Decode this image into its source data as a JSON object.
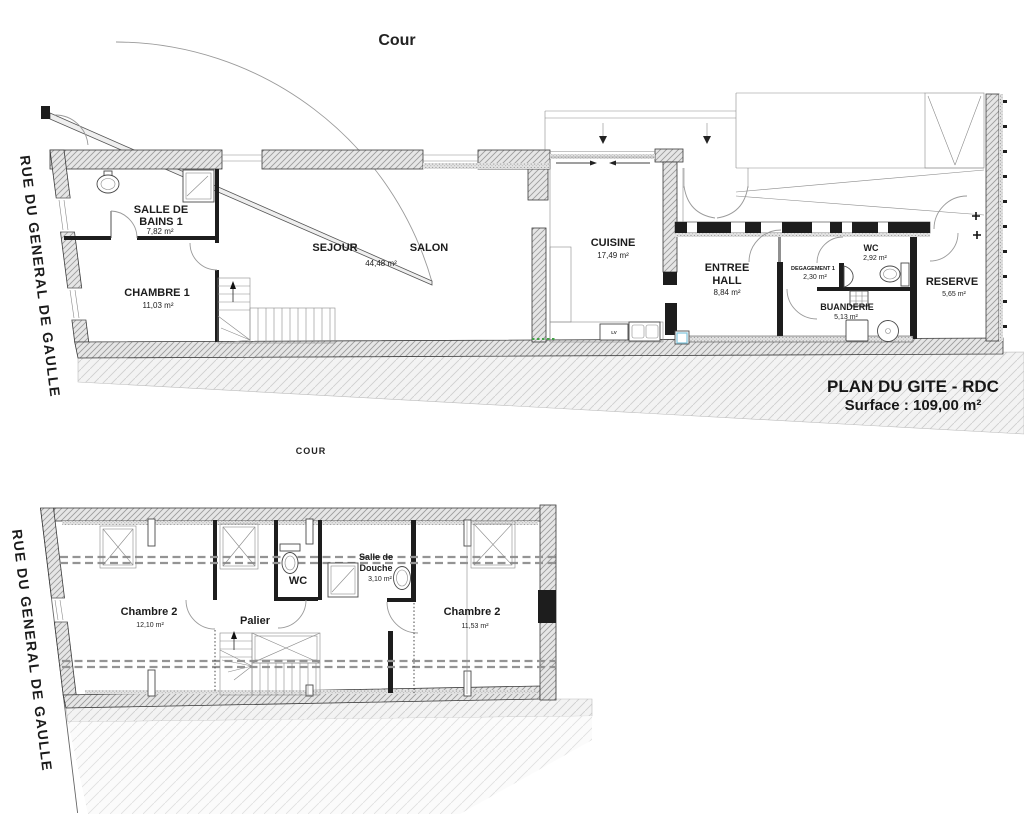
{
  "colors": {
    "line": "#2b2b2b",
    "wall_hatch": "#e6e6e6",
    "green_marker": "#43a047",
    "blue_marker": "#7fc4dc"
  },
  "labels": {
    "cour_top": "Cour",
    "cour_etage": "COUR",
    "street_top": "RUE DU GENERAL DE GAULLE",
    "street_bottom": "RUE DU GENERAL DE GAULLE"
  },
  "title": {
    "line1": "PLAN DU GITE - RDC",
    "line2": "Surface : 109,00 m²"
  },
  "rdc": {
    "salle_de_bains": {
      "line1": "SALLE DE",
      "line2": "BAINS 1",
      "area": "7,82 m²"
    },
    "chambre1": {
      "name": "CHAMBRE 1",
      "area": "11,03 m²"
    },
    "sejour": {
      "name": "SEJOUR"
    },
    "salon": {
      "name": "SALON",
      "area": "44,48 m²"
    },
    "cuisine": {
      "name": "CUISINE",
      "area": "17,49 m²"
    },
    "entree": {
      "line1": "ENTREE",
      "line2": "HALL",
      "area": "8,84 m²"
    },
    "degagement": {
      "name": "DEGAGEMENT 1",
      "area": "2,30 m²"
    },
    "wc": {
      "name": "WC",
      "area": "2,92 m²"
    },
    "buanderie": {
      "name": "BUANDERIE",
      "area": "5,13 m²"
    },
    "reserve": {
      "name": "RESERVE",
      "area": "5,65 m²"
    },
    "dishwasher": "LV"
  },
  "etage": {
    "chambre2_left": {
      "name": "Chambre 2",
      "area": "12,10 m²"
    },
    "palier": {
      "name": "Palier"
    },
    "wc": {
      "name": "WC"
    },
    "douche": {
      "line1": "Salle de",
      "line2": "Douche",
      "area": "3,10 m²"
    },
    "chambre2_right": {
      "name": "Chambre 2",
      "area": "11,53 m²"
    }
  }
}
